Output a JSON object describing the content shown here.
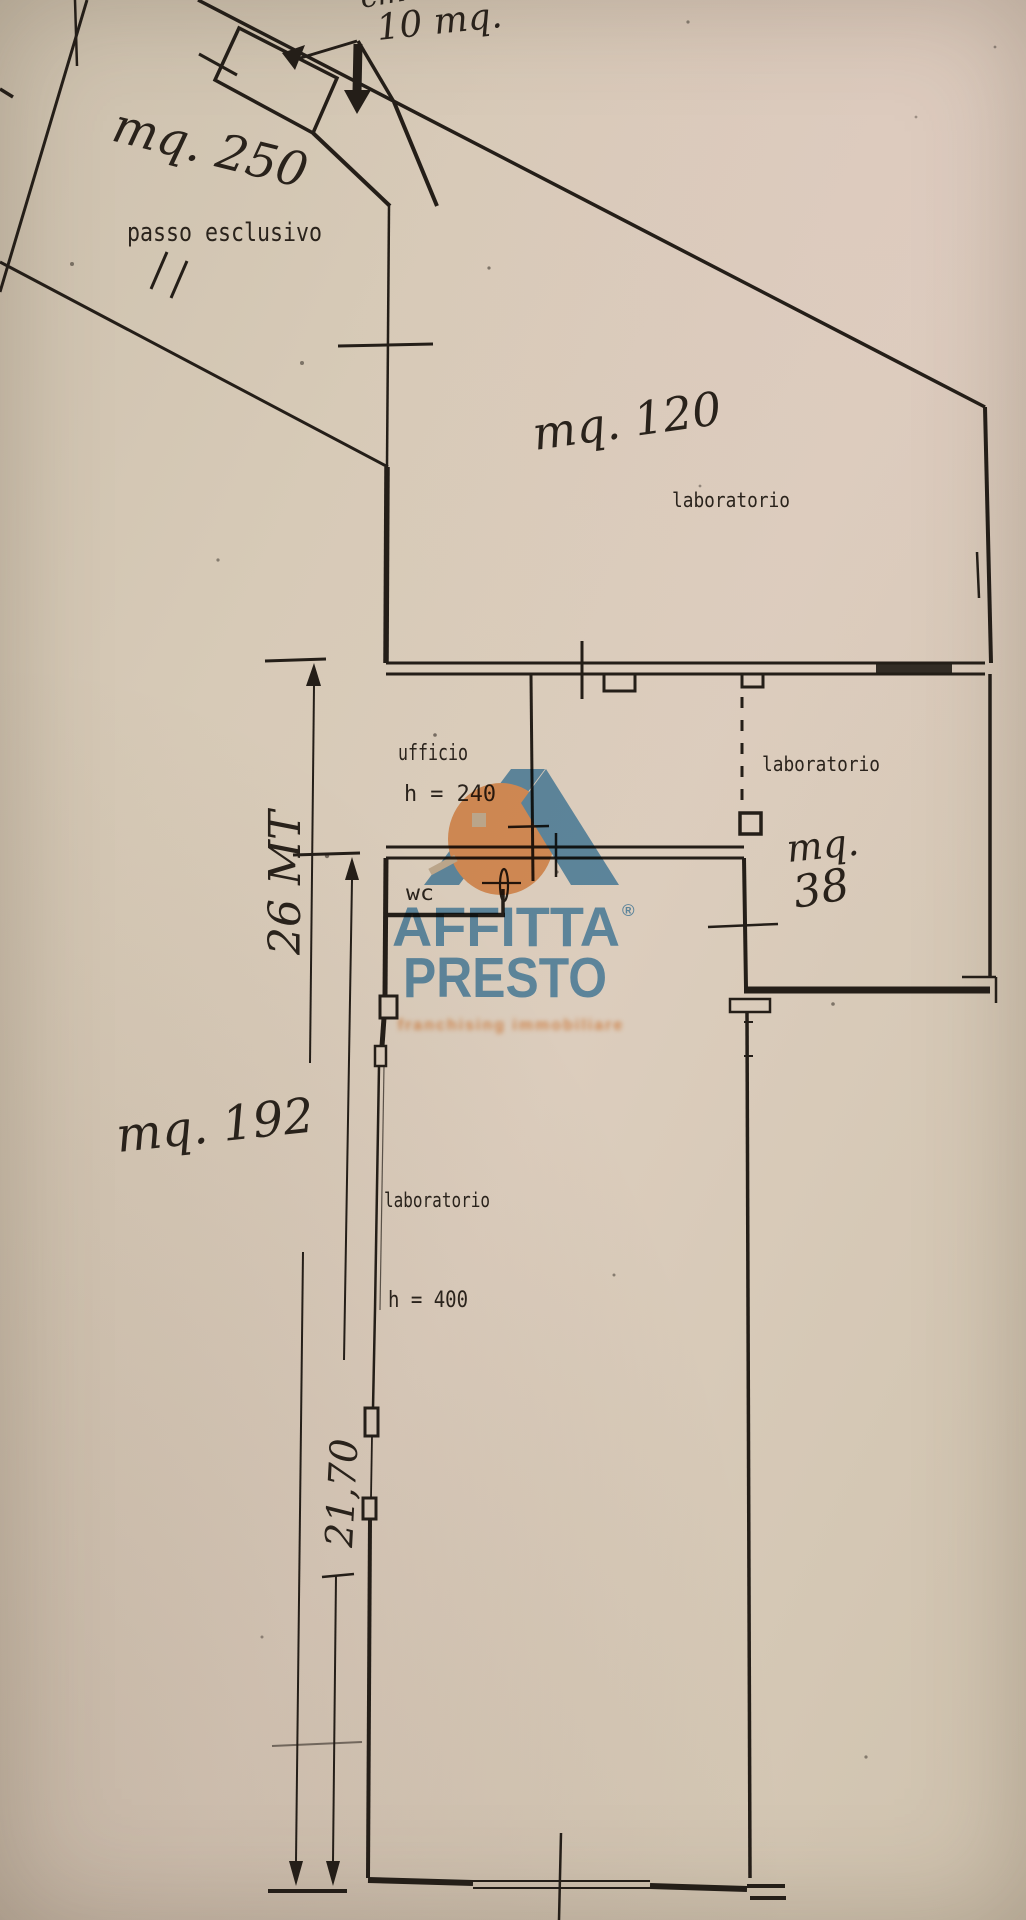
{
  "notes": {
    "top_partial": "cm",
    "small_structure_area": "10 mq."
  },
  "passo": {
    "area": "mq. 250",
    "label": "passo esclusivo"
  },
  "lab120": {
    "area": "mq. 120",
    "label": "laboratorio"
  },
  "ufficio": {
    "label": "ufficio",
    "height": "h = 240"
  },
  "wc": {
    "label": "wc"
  },
  "lab38": {
    "label": "laboratorio",
    "area_unit": "mq.",
    "area_value": "38"
  },
  "lab192": {
    "area": "mq. 192",
    "label": "laboratorio",
    "height": "h = 400"
  },
  "dimensions": {
    "left_total": "26 MT",
    "left_partial": "21,70"
  },
  "logo": {
    "line1": "AFFITTA",
    "registered": "®",
    "line2": "PRESTO",
    "tagline": "franchising immobiliare",
    "blue": "#5e9ccc",
    "orange": "#efa263"
  },
  "colors": {
    "paper": "#d7cab7",
    "ink": "#241e18"
  }
}
